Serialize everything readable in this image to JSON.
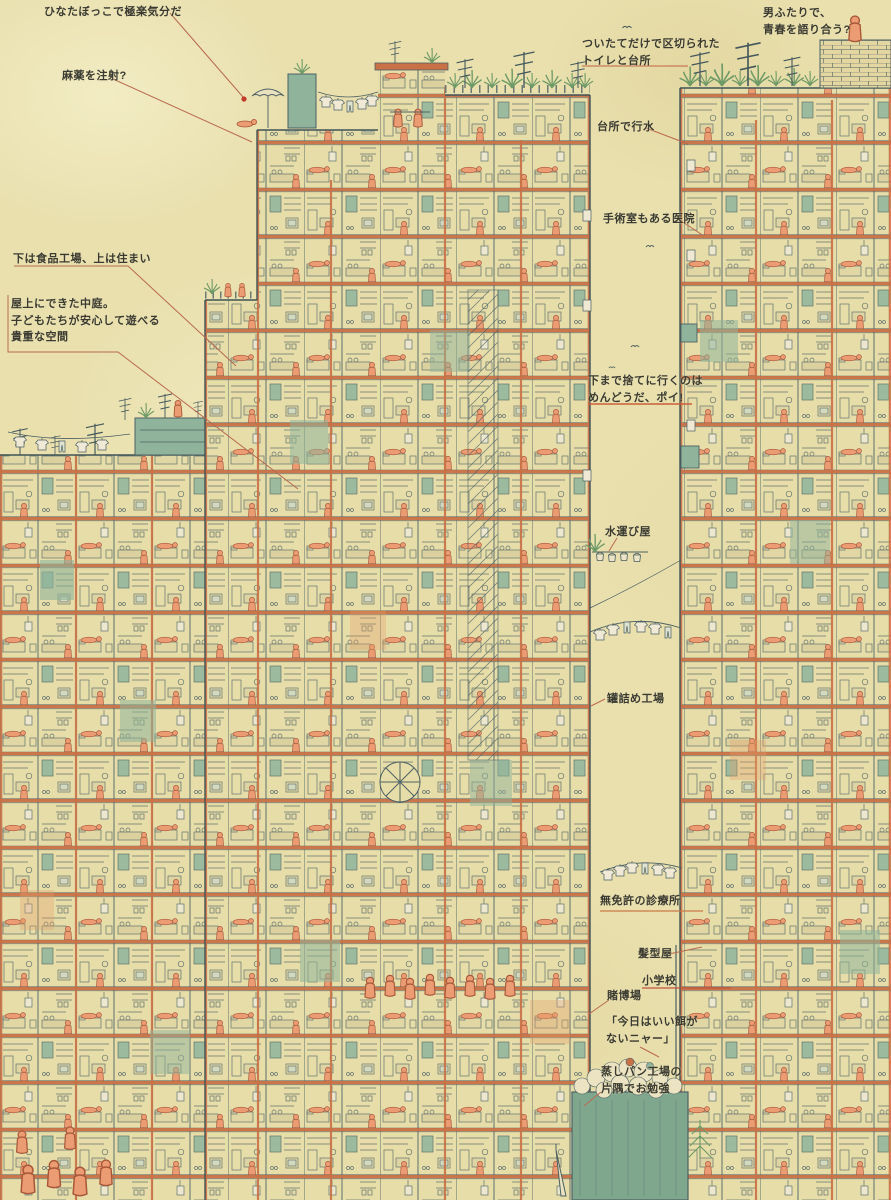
{
  "annotations": {
    "sunbathing": {
      "text": "ひなたぼっこで極楽気分だ"
    },
    "drug_injection": {
      "text": "麻薬を注射?"
    },
    "partition_toilet_kitchen": {
      "text": "ついたてだけで区切られた\nトイレと台所"
    },
    "two_men_youth": {
      "text": "男ふたりで、\n青春を語り合う?"
    },
    "kitchen_bathing": {
      "text": "台所で行水"
    },
    "clinic_with_surgery": {
      "text": "手術室もある医院"
    },
    "food_factory_below": {
      "text": "下は食品工場、上は住まい"
    },
    "rooftop_courtyard": {
      "text": "屋上にできた中庭。\n子どもたちが安心して遊べる\n貴重な空間"
    },
    "trash_toss": {
      "text": "下まで捨てに行くのは\nめんどうだ、ポイ!"
    },
    "water_carrier": {
      "text": "水運び屋"
    },
    "canning_factory": {
      "text": "罐詰め工場"
    },
    "unlicensed_clinic": {
      "text": "無免許の診療所"
    },
    "hair_salon": {
      "text": "髪型屋"
    },
    "elementary_school": {
      "text": "小学校"
    },
    "gambling_den": {
      "text": "賭博場"
    },
    "cat_no_food": {
      "text": "「今日はいい餌が\nないニャー」"
    },
    "steamed_bun_study": {
      "text": "蒸しパン工場の\n片隅でお勉強"
    }
  },
  "colors": {
    "paper": "#e9e0ae",
    "linework": "#4c6164",
    "structure_orange": "#c97146",
    "people_orange": "#ec9c72",
    "teal_green": "#8fb49b",
    "label_text": "#3a3a31",
    "leader_line": "#b96a4e",
    "marker_dot": "#c23a28"
  }
}
